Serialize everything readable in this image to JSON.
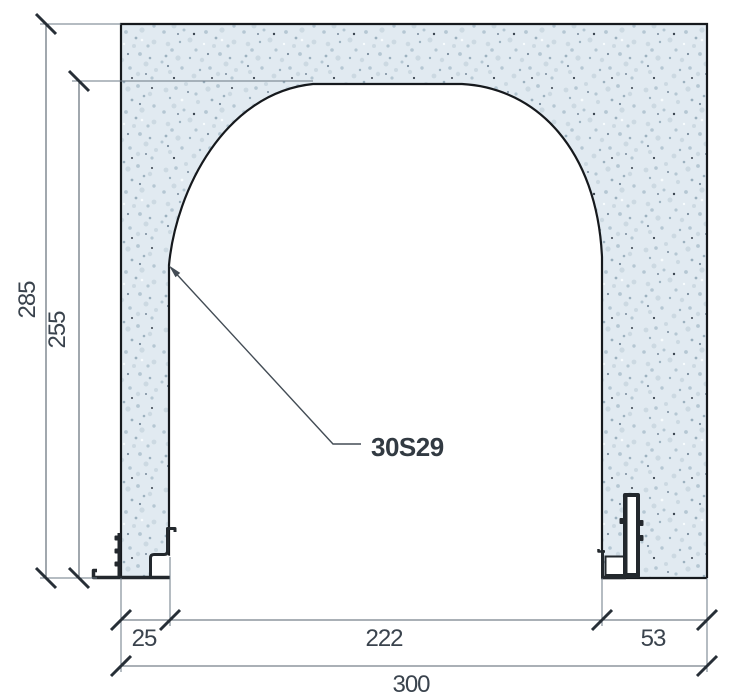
{
  "drawing": {
    "product_code": "30S29",
    "type": "arch-profile-cross-section",
    "dimensions": {
      "overall_height": "285",
      "opening_height": "255",
      "left_jamb_width": "25",
      "opening_width": "222",
      "right_jamb_width": "53",
      "overall_width": "300"
    },
    "colors": {
      "wall_fill_base": "#e1eaf1",
      "speckle_mid": "#b5c7d3",
      "speckle_dark": "#3a444f",
      "outline": "#16191d",
      "dimension_lines": "#55616c",
      "tick_marks": "#272f37",
      "label_text": "#3a434d",
      "metal_profile": "#23282d"
    }
  }
}
